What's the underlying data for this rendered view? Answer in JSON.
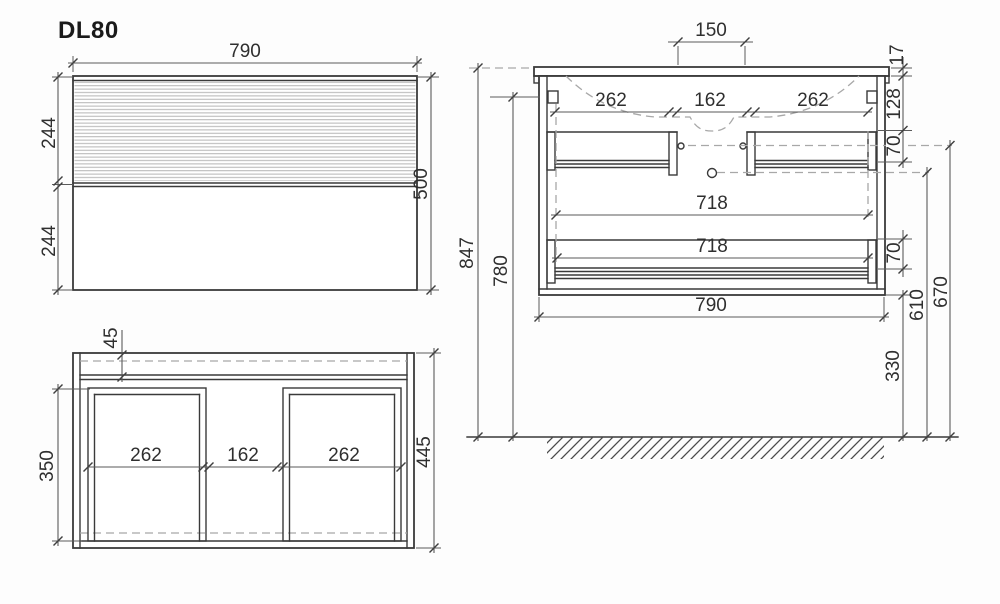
{
  "title": "DL80",
  "front": {
    "width": "790",
    "upper_height": "244",
    "lower_height": "244",
    "total_height": "500"
  },
  "plan": {
    "top_inset": "45",
    "inner_depth": "350",
    "total_depth": "445",
    "left_width": "262",
    "center_width": "162",
    "right_width": "262"
  },
  "side": {
    "faucet_span": "150",
    "top_thickness": "17",
    "apron_height": "128",
    "drawer_front_height": "70",
    "left_width": "262",
    "center_width": "162",
    "right_width": "262",
    "inner_width_upper": "718",
    "inner_width_lower": "718",
    "lower_drawer_height": "70",
    "cabinet_width": "790",
    "height_total": "847",
    "height_mount": "780",
    "height_knob": "670",
    "height_drain": "610",
    "height_underside": "330"
  }
}
